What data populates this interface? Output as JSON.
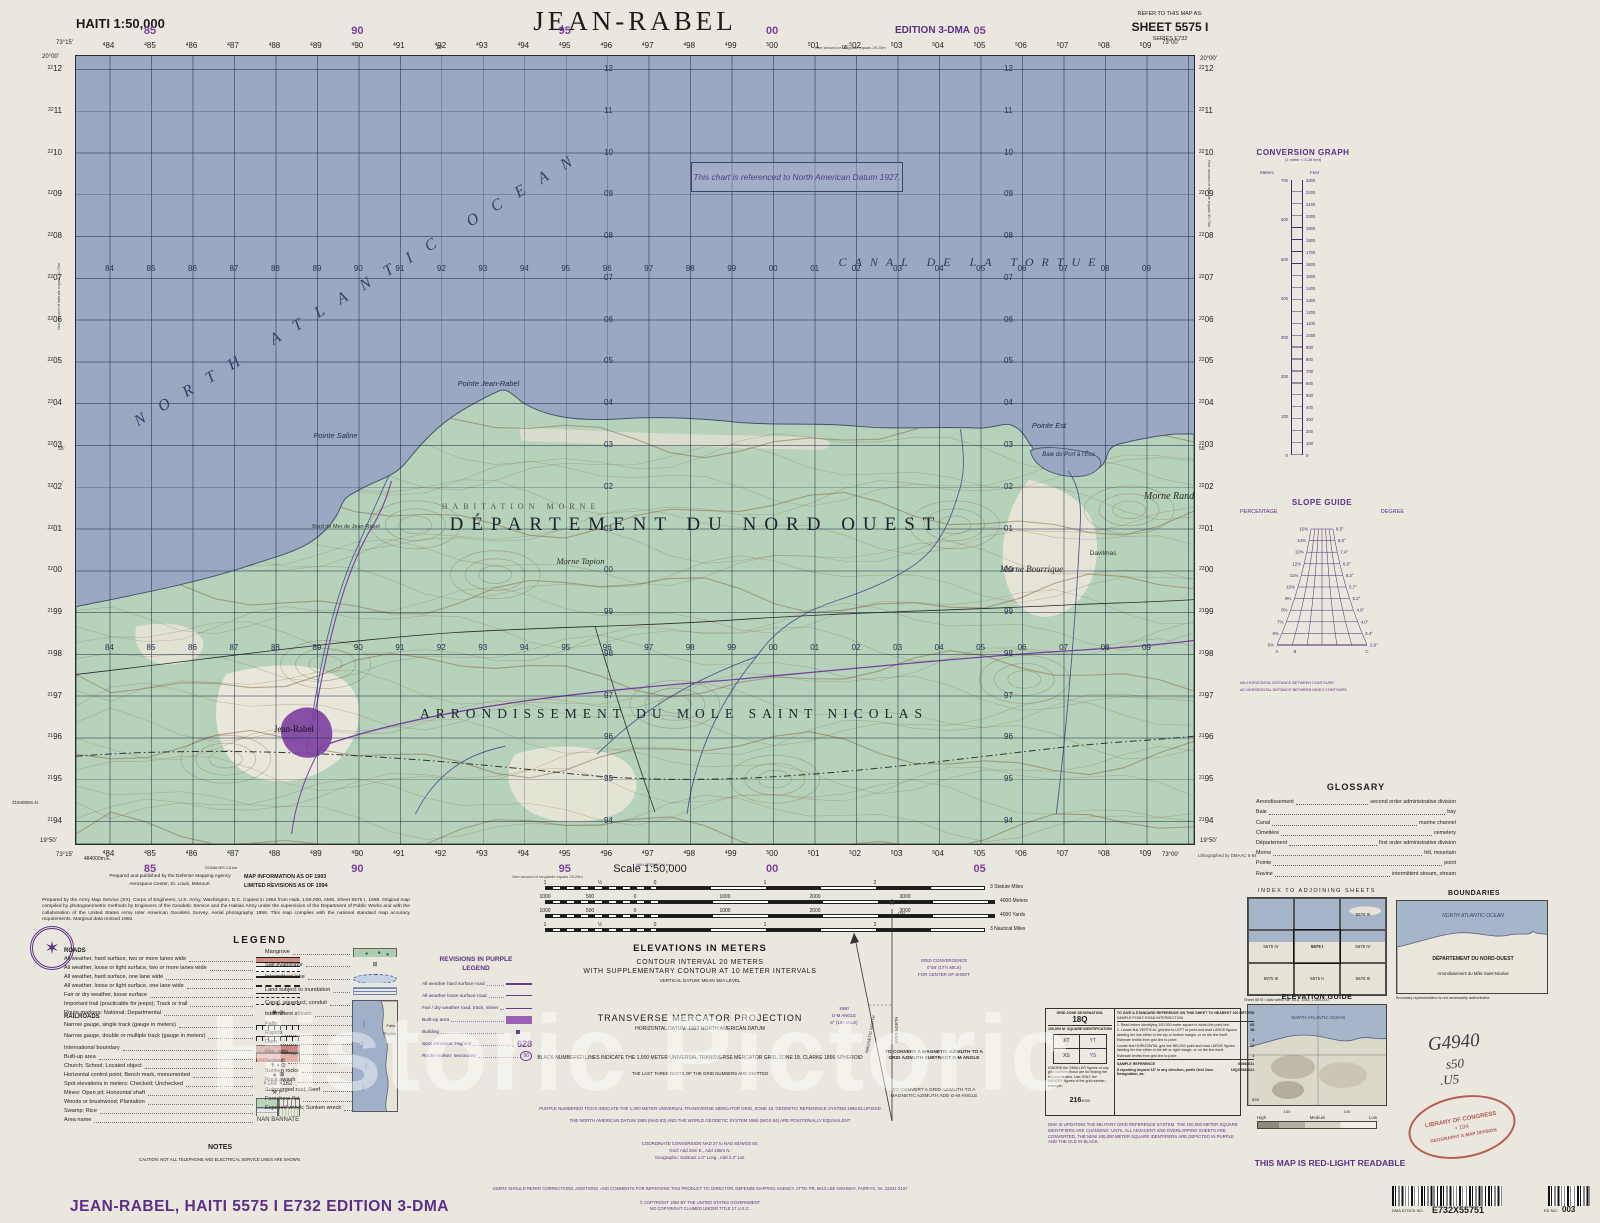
{
  "header": {
    "country_scale": "HAITI 1:50,000",
    "title": "JEAN-RABEL",
    "edition": "EDITION 3-DMA",
    "refer_label": "REFER TO THIS MAP AS:",
    "sheet": "SHEET 5575 I",
    "series": "SERIES E732"
  },
  "watermark": "Historic Pictoric",
  "map": {
    "corners": {
      "tl_lon": "73°15'",
      "tl_lat": "20°00'",
      "tr_lon": "73°00'",
      "tr_lat": "20°00'",
      "bl_lon": "73°15'",
      "bl_lat": "19°50'",
      "br_lon": "73°00'",
      "br_lat": "19°50'"
    },
    "grid": {
      "eastings": [
        "84",
        "85",
        "86",
        "87",
        "88",
        "89",
        "90",
        "91",
        "92",
        "93",
        "94",
        "95",
        "96",
        "97",
        "98",
        "99",
        "00",
        "01",
        "02",
        "03",
        "04",
        "05",
        "06",
        "07",
        "08",
        "09"
      ],
      "purple_eastings": [
        "85",
        "90",
        "95",
        "00",
        "05"
      ],
      "purple_indices": [
        1,
        6,
        11,
        16,
        21
      ],
      "northings": [
        "12",
        "11",
        "10",
        "09",
        "08",
        "07",
        "06",
        "05",
        "04",
        "03",
        "02",
        "01",
        "00",
        "99",
        "98",
        "97",
        "96",
        "95",
        "94"
      ],
      "easting_origin_label": "484000m.E.",
      "northing_origin_label": "2194000m.N."
    },
    "edge_notes": {
      "lon_note": "One second of longitude equals 29.25m",
      "lat_note": "One second of latitude equals 30.75m",
      "litho": "Lithographed by DMAAC 6-94",
      "minute_top": "10'",
      "minute_top2": "05'",
      "minute_side": "55'",
      "dest1": "GONAIVES 1.8 km",
      "dest2": "NAN FERME 2.9 km"
    },
    "labels": {
      "ocean": "NORTH ATLANTIC OCEAN",
      "canal": "CANAL DE LA TORTUE",
      "datum_note": "This chart is referenced to North American Datum 1927.",
      "departement": "DÉPARTEMENT DU NORD OUEST",
      "arrondissement": "ARRONDISSEMENT DU MOLE SAINT NICOLAS",
      "habitation": "HABITATION MORNE",
      "pointe_jean_rabel": "Pointe Jean-Rabel",
      "pointe_saline": "Pointe Saline",
      "pointe_est": "Pointe Est",
      "baie": "Baie du Port à l'Écu",
      "bord_de_mer": "Bord de Mer de Jean-Rabel",
      "jean_rabel": "Jean-Rabel",
      "morne_tapion": "Morne Tapion",
      "morne_bourrique": "Morne Bourrique",
      "morne_rand": "Morne Rand",
      "davilmas": "Davilmas"
    }
  },
  "right_margin": {
    "conversion": {
      "title": "CONVERSION GRAPH",
      "subtitle": "(1 meter = 3.28 feet)",
      "left": "Meters",
      "right": "Feet",
      "meters": [
        "700",
        "600",
        "500",
        "400",
        "300",
        "200",
        "100",
        "0"
      ],
      "feet": [
        "2300",
        "2200",
        "2100",
        "2000",
        "1900",
        "1800",
        "1700",
        "1600",
        "1500",
        "1400",
        "1300",
        "1200",
        "1100",
        "1000",
        "900",
        "800",
        "700",
        "600",
        "500",
        "400",
        "300",
        "200",
        "100",
        "0"
      ]
    },
    "slope": {
      "title": "SLOPE GUIDE",
      "left": "PERCENTAGE",
      "right": "DEGREE",
      "pct": [
        "15%",
        "14%",
        "13%",
        "12%",
        "11%",
        "10%",
        "9%",
        "8%",
        "7%",
        "6%",
        "5%"
      ],
      "deg": [
        "8.5°",
        "8.0°",
        "7.4°",
        "6.8°",
        "6.3°",
        "5.7°",
        "5.2°",
        "4.6°",
        "4.0°",
        "3.4°",
        "2.9°"
      ],
      "pts": [
        "A",
        "B",
        "C"
      ],
      "note1": "AB=HORIZONTAL DISTANCE BETWEEN CONTOURS",
      "note2": "AC=HORIZONTAL DISTANCE BETWEEN INDEX CONTOURS"
    },
    "glossary": {
      "title": "GLOSSARY",
      "entries": [
        [
          "Arrondissement",
          "second order administrative division"
        ],
        [
          "Baie",
          "bay"
        ],
        [
          "Canal",
          "marine channel"
        ],
        [
          "Cimetière",
          "cemetery"
        ],
        [
          "Département",
          "first order administrative division"
        ],
        [
          "Morne",
          "hill, mountain"
        ],
        [
          "Pointe",
          "point"
        ],
        [
          "Ravine",
          "intermittent stream, stream"
        ]
      ]
    }
  },
  "bottom_right": {
    "index": {
      "title": "INDEX TO ADJOINING SHEETS",
      "cells": [
        "",
        "",
        "5576 III",
        "5575 IV",
        "5575 I",
        "5675 IV",
        "5575 III",
        "5575 II",
        "5675 III"
      ],
      "caption": "Sheet 5575 I falls within NE 18-4, 1945, 1:250,000"
    },
    "boundaries": {
      "title": "BOUNDARIES",
      "ocean": "NORTH ATLANTIC OCEAN",
      "departement": "DÉPARTEMENT DU NORD-OUEST",
      "arrondissement": "Arrondissement du Môle Saint-Nicolas",
      "caption": "Boundary representation is not necessarily  authoritative."
    },
    "elevation_guide": {
      "title": "ELEVATION GUIDE",
      "ocean": "NORTH ATLANTIC OCEAN",
      "spot": "628",
      "tick1": "150",
      "tick2": "100",
      "bands": [
        "High",
        "Medium",
        "Low"
      ]
    },
    "red_light": "THIS MAP IS RED-LIGHT READABLE",
    "handwriting": {
      "line1": "G4940",
      "line2": "s50",
      "line3": ".U5"
    },
    "stamp": {
      "line1": "LIBRARY OF CONGRESS",
      "line2": "• 194",
      "line3": "GEOGRAPHY & MAP DIVISION"
    },
    "stock": {
      "label": "DMA STOCK NO.",
      "value": "E732X55751"
    },
    "ed": {
      "label": "ED NO.",
      "value": "003"
    }
  },
  "bottom_left": {
    "publisher1": "Prepared and published by the Defense Mapping Agency",
    "publisher2": "Aerospace Center, St. Louis, Missouri.",
    "info1": "MAP INFORMATION AS OF 1993",
    "info2": "LIMITED REVISIONS AS OF 1994",
    "credit": "Prepared by the Army Map Service (SX), Corps of Engineers, U.S. Army, Washington, D.C. Copied in 1962 from Haiti, 1:50,000, AMS, Sheet 5575 I, 1958. Original map compiled by photogrammetric methods by Engineers of the Geodetic Service and the Haitian Army under the supervision of the Department of Public Works and with the collaboration of the United States Army Inter American Geodetic Survey. Aerial photography 1956. This map complies with the national standard map accuracy requirements. Marginal data revised 1962."
  },
  "legend": {
    "title": "LEGEND",
    "roads_header": "ROADS",
    "railroads_header": "RAILROADS",
    "roads": [
      {
        "label": "All weather, hard surface, two or more lanes wide",
        "sym": "road-2lane"
      },
      {
        "label": "All weather, loose or light surface, two or more lanes wide",
        "sym": "road-2lane-loose"
      },
      {
        "label": "All weather, hard surface, one lane wide",
        "sym": "road-1lane"
      },
      {
        "label": "All weather, loose or light surface, one lane wide",
        "sym": "road-1lane-loose"
      },
      {
        "label": "Fair or dry weather, loose surface",
        "sym": "road-fair"
      },
      {
        "label": "Important trail (practicable for jeeps); Track or trail",
        "sym": "trail"
      },
      {
        "label": "Route markers: National; Departmental",
        "sym": "route-markers"
      }
    ],
    "railroads": [
      {
        "label": "Narrow gauge, single track (gauge in meters)",
        "sym": "rail-single"
      },
      {
        "label": "Narrow gauge, double or multiple track (gauge in meters)",
        "sym": "rail-multi"
      }
    ],
    "misc": [
      {
        "label": "International boundary",
        "sym": "intl-boundary"
      },
      {
        "label": "Built-up area",
        "sym": "builtup"
      },
      {
        "label": "Church; School; Located object",
        "sym": "church-school"
      },
      {
        "label": "Horizontal control point; Bench mark, monumented",
        "sym": "control-point"
      },
      {
        "label": "Spot elevations in meters: Checked; Unchecked",
        "sym": "spot-elev"
      },
      {
        "label": "Mines: Open pit; Horizontal shaft",
        "sym": "mines"
      },
      {
        "label": "Woods or brushwood; Plantation",
        "sym": "woods"
      },
      {
        "label": "Swamp; Rice",
        "sym": "swamp"
      },
      {
        "label": "Area name",
        "sym": "area-name"
      }
    ],
    "right": [
      {
        "label": "Mangrove",
        "sym": "mangrove"
      },
      {
        "label": "Salt evaporator",
        "sym": "salt-evap"
      },
      {
        "label": "Intermittent lake",
        "sym": "intermittent-lake"
      },
      {
        "label": "Land subject to inundation",
        "sym": "inundation"
      },
      {
        "label": "Canal, aqueduct, conduit",
        "sym": "canal"
      },
      {
        "label": "Intermittent stream",
        "sym": null
      },
      {
        "label": "Falls",
        "sym": null
      },
      {
        "label": "Rapids",
        "sym": null
      },
      {
        "label": "Dam",
        "sym": null
      },
      {
        "label": "Pier, jetty",
        "sym": null
      },
      {
        "label": "Seawall",
        "sym": null
      },
      {
        "label": "Sunken rocks",
        "sym": null
      },
      {
        "label": "Rock awash",
        "sym": null
      },
      {
        "label": "Submerged reef; Reef",
        "sym": null
      },
      {
        "label": "Foreshore flat",
        "sym": null
      },
      {
        "label": "Exposed wreck; Sunken wreck",
        "sym": null
      }
    ],
    "diagram_falls": "Falls",
    "diagram_rapids": "Rapids"
  },
  "purple_legend": {
    "title1": "REVISIONS IN PURPLE",
    "title2": "LEGEND",
    "items": [
      {
        "label": "All weather hard surface road",
        "sym": "p-road1",
        "value": ""
      },
      {
        "label": "All weather loose surface road",
        "sym": "p-road2",
        "value": ""
      },
      {
        "label": "Fair / dry weather road, track, street",
        "sym": "p-road3",
        "value": ""
      },
      {
        "label": "Built-up area",
        "sym": "p-builtup",
        "value": ""
      },
      {
        "label": "Building",
        "sym": "p-building",
        "value": ""
      },
      {
        "label": "Spot elevation: Highest",
        "sym": "p-spot",
        "value": ". 628"
      },
      {
        "label": "Route marker: secondary",
        "sym": "p-route",
        "value": "90"
      }
    ]
  },
  "notes": {
    "title": "NOTES",
    "caution": "CAUTION:  NOT ALL TELEPHONE AND ELECTRICAL SERVICE LINES ARE SHOWN."
  },
  "footer": {
    "title": "JEAN-RABEL,  HAITI   5575 I   E732   EDITION  3-DMA"
  },
  "scale": {
    "title": "Scale 1:50,000",
    "bars": [
      {
        "ticks": [
          "1",
          "½",
          "0",
          "1",
          "2"
        ],
        "fr": [
          0,
          0.125,
          0.25,
          0.5,
          0.75
        ],
        "w": 440,
        "unit": "3 Statute Miles"
      },
      {
        "ticks": [
          "1000",
          "500",
          "0",
          "1000",
          "2000",
          "3000"
        ],
        "fr": [
          0,
          0.1,
          0.2,
          0.4,
          0.6,
          0.8
        ],
        "w": 450,
        "unit": "4000 Meters"
      },
      {
        "ticks": [
          "1000",
          "500",
          "0",
          "1000",
          "2000",
          "3000"
        ],
        "fr": [
          0,
          0.1,
          0.2,
          0.4,
          0.6,
          0.8
        ],
        "w": 450,
        "unit": "4000 Yards"
      },
      {
        "ticks": [
          "1",
          "½",
          "0",
          "1",
          "2"
        ],
        "fr": [
          0,
          0.125,
          0.25,
          0.5,
          0.75
        ],
        "w": 440,
        "unit": "3 Nautical Miles"
      }
    ]
  },
  "elevations": {
    "l1": "ELEVATIONS IN METERS",
    "l2": "CONTOUR INTERVAL 20 METERS",
    "l3": "WITH SUPPLEMENTARY CONTOUR AT 10 METER INTERVALS",
    "l4": "VERTICAL DATUM: MEAN SEA LEVEL"
  },
  "projection": {
    "l1": "TRANSVERSE MERCATOR PROJECTION",
    "l2": "HORIZONTAL DATUM: 1927 NORTH AMERICAN DATUM",
    "l3": "BLACK NUMBERED LINES INDICATE THE 1,000 METER UNIVERSAL TRANSVERSE MERCATOR GRID, ZONE 18, CLARKE 1866 SPHEROID",
    "l4": "THE LAST THREE DIGITS OF THE GRID NUMBERS ARE OMITTED",
    "purple1": "PURPLE NUMBERED TICKS INDICATE THE 1,000 METER UNIVERSAL TRANSVERSE MERCATOR GRID, ZONE 18, GEODETIC REFERENCE SYSTEM 1980 ELLIPSOID",
    "purple2": "THE NORTH AMERICAN DATUM 1983 (NAD 83) AND THE WORLD GEODETIC SYSTEM 1984 (WGS 84) ARE POSITIONALLY EQUIVALENT",
    "conv_title": "COORDINATE CONVERSION NAD 27 to NAD 83/WGS 84:",
    "conv_grid": "Grid:  Add 25m E., Add 195m N.",
    "conv_geo": "Geographic:  Subtract 1.0\" Long., Add 2.2\" Lat."
  },
  "declination": {
    "gn": "GN",
    "grid_north": "GRID NORTH",
    "magnetic_north": "MAGNETIC NORTH",
    "conv1": "GRID CONVERGENCE",
    "conv2": "0°58' (17½ MILS)",
    "conv3": "FOR CENTER OF SHEET",
    "gm1": "1990",
    "gm2": "G-M ANGLE",
    "gm3": "8° (140 MILS)",
    "to_grid": "TO CONVERT A MAGNETIC AZIMUTH TO A GRID AZIMUTH SUBTRACT G-M ANGLE",
    "to_magnetic": "TO CONVERT A GRID AZIMUTH TO A MAGNETIC AZIMUTH ADD G-M ANGLE"
  },
  "grid_ref": {
    "gzd_label": "GRID ZONE DESIGNATION:",
    "gzd": "18Q",
    "sq_label": "100,000 M. SQUARE IDENTIFICATION",
    "squares": [
      "XT",
      "YT",
      "XS",
      "YS"
    ],
    "ignore_note": "IGNORE the SMALLER figures of any grid number; those are for finding the full coordinates. Use ONLY the LARGER figures of the grid number; example:",
    "example_big": "216",
    "example_small": "4000",
    "right_title": "TO GIVE A STANDARD REFERENCE ON THIS SHEET TO NEAREST 100 METERS",
    "sample_point": "SAMPLE POINT:  ROAD INTERSECTION",
    "steps": [
      {
        "t": "1. Read letters identifying 100,000 meter square in which the point lies:",
        "v": "XS"
      },
      {
        "t": "2. Locate first VERTICAL grid line to LEFT of point and read LARGE figures labeling the line either in the top or bottom margin, or on the line itself:",
        "v": "98"
      },
      {
        "t": "Estimate tenths from grid line to point:",
        "v": "4"
      },
      {
        "t": "Locate first HORIZONTAL grid line BELOW point and read LARGE figures labeling the line either in the left or right margin, or on the line itself:",
        "v": "02"
      },
      {
        "t": "Estimate tenths from grid line to point:",
        "v": "1"
      }
    ],
    "refs": [
      {
        "t": "SAMPLE REFERENCE",
        "v": "XS984021"
      },
      {
        "t": "If reporting beyond 18° in any direction, prefix Grid Zone Designation, as:",
        "v": "18QXS984021"
      }
    ],
    "dma_update": "DMA IS UPDATING THE MILITARY GRID REFERENCE SYSTEM. THE 100,000 METER SQUARE IDENTIFIERS ARE CHANGING. UNTIL ALL ADJACENT AND OVERLAPPING SHEETS ARE CONVERTED, THE NEW 100,000 METER SQUARE IDENTIFIERS ARE DEPICTED IN PURPLE AND THE OLD IN BLACK."
  },
  "footer_small": {
    "users_note": "USERS SHOULD REFER CORRECTIONS, ADDITIONS, AND COMMENTS FOR IMPROVING THIS PRODUCT TO: DIRECTOR, DEFENSE MAPPING AGENCY, ATTN: PR, 8613 LEE HIGHWAY, FAIRFAX, VA. 22031-2137",
    "copyright1": "© COPYRIGHT 1994 BY THE UNITED STATES GOVERNMENT",
    "copyright2": "NO COPYRIGHT CLAIMED UNDER TITLE 17 U.S.C."
  }
}
